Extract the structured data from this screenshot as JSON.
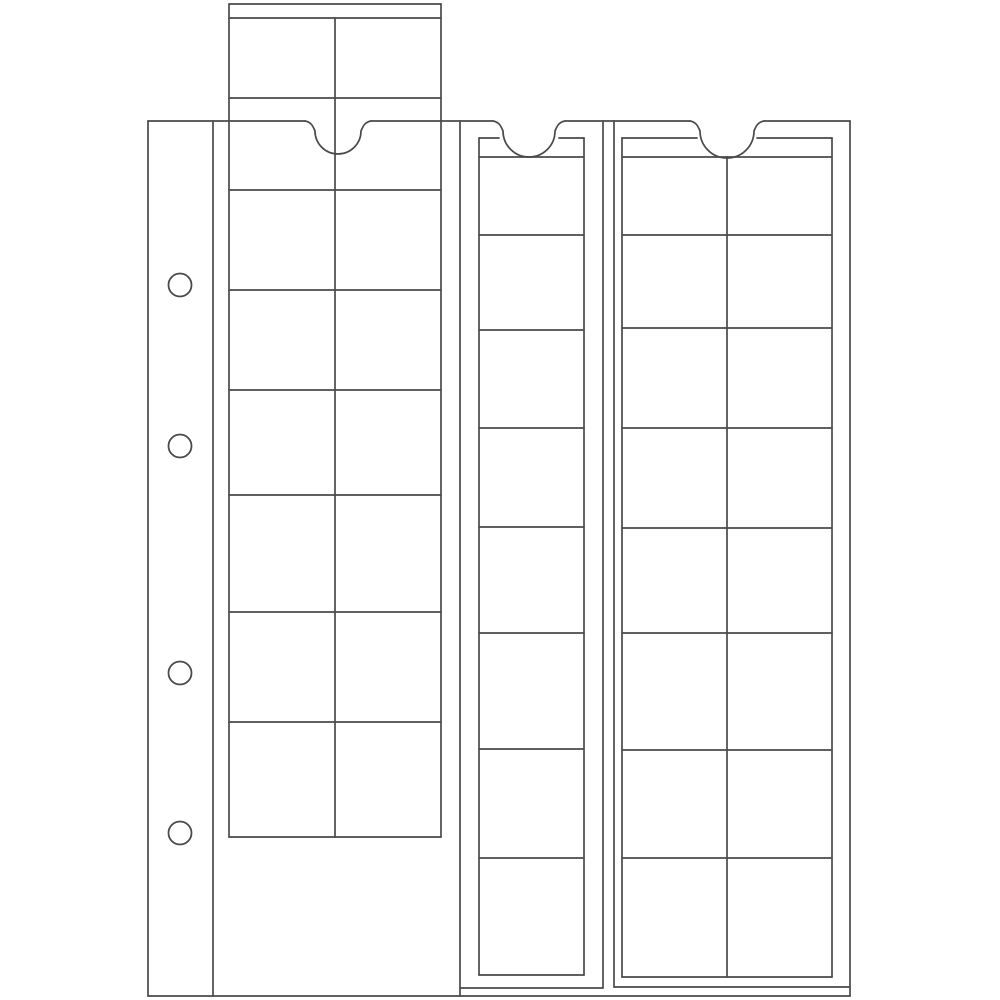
{
  "figure": {
    "description_label": "",
    "canvas": {
      "width": 1000,
      "height": 1000,
      "background_color": "#ffffff",
      "line_color": "#4a4a4a",
      "line_width": 1.7
    },
    "page": {
      "left": 148,
      "top": 121,
      "right": 850,
      "bottom": 996,
      "margin_line_x": 213,
      "seam_line_x": 460,
      "binder_holes": {
        "cx": 180,
        "r": 11.5,
        "cys": [
          285,
          446,
          673,
          833
        ],
        "count": 4
      },
      "notches": [
        {
          "name": "left-strip-notch",
          "cx": 338,
          "half_span": 33
        },
        {
          "name": "middle-strip-notch",
          "cx": 529,
          "half_span": 36
        },
        {
          "name": "right-strip-notch",
          "cx": 727,
          "half_span": 37
        }
      ],
      "sleeves": [
        {
          "name": "middle-sleeve",
          "lines": [
            [
              603,
              121,
              603,
              988
            ],
            [
              460,
              988,
              603,
              988
            ]
          ]
        },
        {
          "name": "right-sleeve",
          "lines": [
            [
              614,
              121,
              614,
              987
            ],
            [
              614,
              987,
              850,
              987
            ]
          ]
        }
      ]
    },
    "strips": [
      {
        "name": "left-slider",
        "left": 229,
        "top": 4,
        "right": 441,
        "bottom": 837,
        "band_lines": [
          18,
          98
        ],
        "row_lines": [
          190,
          290,
          390,
          495,
          612,
          722
        ],
        "center_divider_x": 335,
        "divider_from_y": 18,
        "top_gap": null,
        "columns": 2,
        "rows": 8,
        "pockets": 16
      },
      {
        "name": "middle-slider",
        "left": 479,
        "top": 138,
        "right": 584,
        "bottom": 975,
        "band_lines": [
          157
        ],
        "row_lines": [
          235,
          330,
          428,
          527,
          633,
          749,
          858
        ],
        "center_divider_x": null,
        "divider_from_y": null,
        "top_gap": [
          499,
          559
        ],
        "columns": 1,
        "rows": 8,
        "pockets": 8
      },
      {
        "name": "right-slider",
        "left": 622,
        "top": 138,
        "right": 832,
        "bottom": 977,
        "band_lines": [
          157
        ],
        "row_lines": [
          235,
          328,
          428,
          528,
          633,
          750,
          858
        ],
        "center_divider_x": 727,
        "divider_from_y": 157,
        "top_gap": [
          697,
          757
        ],
        "columns": 2,
        "rows": 8,
        "pockets": 16
      }
    ]
  }
}
